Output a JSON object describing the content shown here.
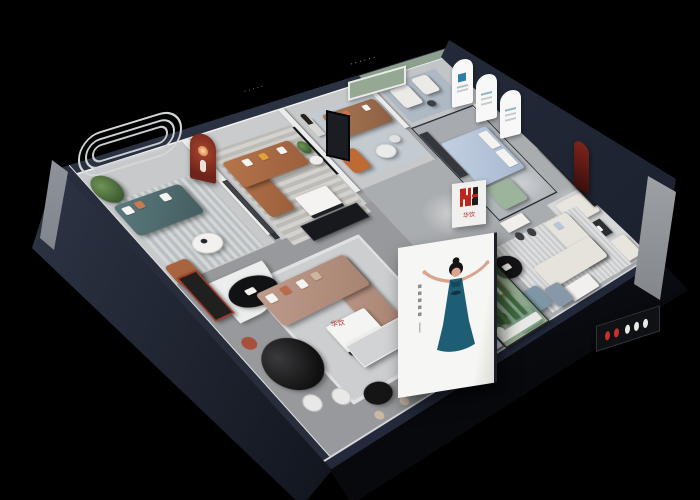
{
  "scene": {
    "type": "3d-isometric-showroom-dollhouse-render",
    "background_color": "#000000",
    "description": "Cutaway overhead 3D render of a furniture brand showroom with multiple lit room vignettes"
  },
  "brand": {
    "logo_mark": "H",
    "logo_text": "华饮",
    "logo_red": "#c0271c",
    "logo_black": "#1c1c1c"
  },
  "poster": {
    "subject": "woman in blue evening dress with arms outstretched",
    "background_color": "#f5f5f3",
    "dress_color": "#1e5e75",
    "caption_orientation": "vertical",
    "caption_legible": false
  },
  "palette": {
    "outer_wall_navy": "#2a3140",
    "inner_wall_white": "#ececec",
    "floor_gray": "#a6a8ab",
    "red_arch_niche": "#7e2f22",
    "wine_arch_niche": "#5e1d16",
    "sage_green_wall": "#8d9f8d",
    "sofa_teal": "#4e6b6e",
    "sofa_brown": "#a96a44",
    "sofa_taupe": "#b28e7e",
    "sofa_cream": "#e6e3dd",
    "daybed_blue": "#b5c4da",
    "chair_orange": "#c06a33",
    "terrarium_green": "#6faa64"
  },
  "rooms": [
    {
      "id": "lounge-teal",
      "furniture": [
        "teal-sofa",
        "round-coffee-table",
        "potted-plant",
        "striped-rug",
        "leather-armchair",
        "curved-line-wall-art",
        "red-arch-niche"
      ]
    },
    {
      "id": "lounge-brown-left",
      "furniture": [
        "brown-leather-sofa",
        "white-coffee-table",
        "rug",
        "tv-panel",
        "black-media-console"
      ]
    },
    {
      "id": "lounge-brown-top",
      "furniture": [
        "brown-sofa",
        "statue",
        "glass-coffee-tables",
        "orange-armchair",
        "sage-niche",
        "dot-text-decal"
      ]
    },
    {
      "id": "gallery-arches",
      "furniture": [
        "three-arched-displays",
        "white-armchairs",
        "side-table"
      ]
    },
    {
      "id": "glass-lounge",
      "furniture": [
        "blue-daybed",
        "green-chaise",
        "dark-cabinet",
        "glass-walls"
      ]
    },
    {
      "id": "right-wing",
      "furniture": [
        "cream-sofa-pair",
        "cream-l-sofa",
        "black-oval-table",
        "wine-arch-niche",
        "media-wall",
        "brand-display-shelf",
        "white-desk-and-chairs",
        "red-frame-daybed",
        "logo-partition"
      ]
    },
    {
      "id": "front-lounge",
      "furniture": [
        "taupe-sectional-sofa",
        "white-coffee-table",
        "curved-partition",
        "black-oval-display-table",
        "blue-armchairs",
        "ottoman",
        "reception-counter",
        "cactus-terrarium",
        "poster-lightbox"
      ]
    },
    {
      "id": "dining-display",
      "furniture": [
        "black-oval-dining-table",
        "dining-chairs",
        "red-display-shelf",
        "bar-table",
        "stools",
        "pale-blue-bed",
        "black-bench"
      ]
    }
  ]
}
